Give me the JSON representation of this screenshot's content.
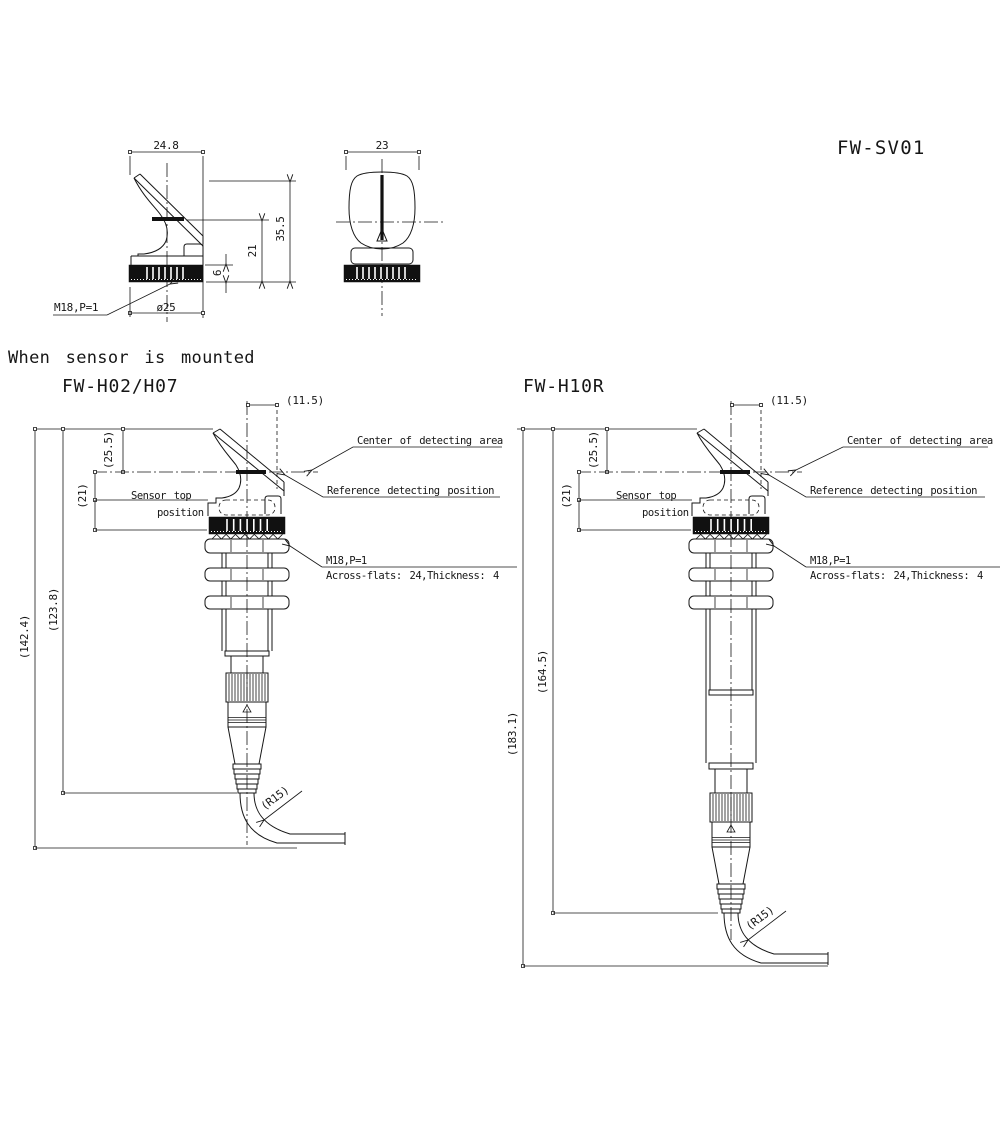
{
  "title": {
    "model": "FW-SV01"
  },
  "heading": "When sensor is mounted",
  "side_view": {
    "width": "24.8",
    "height": "35.5",
    "center_height": "21",
    "nut_height": "6",
    "diameter": "ø25",
    "thread": "M18,P=1"
  },
  "front_view": {
    "width": "23"
  },
  "left": {
    "label": "FW-H02/H07",
    "offset": "(11.5)",
    "center_depth": "(25.5)",
    "top_depth": "(21)",
    "inner_length": "(123.8)",
    "overall_length": "(142.4)",
    "bend_radius": "(R15)",
    "sensor_top_line1": "Sensor top",
    "sensor_top_line2": "position",
    "center_note": "Center of detecting area",
    "reference_note": "Reference detecting position",
    "thread": "M18,P=1",
    "flats": "Across-flats: 24,Thickness: 4"
  },
  "right": {
    "label": "FW-H10R",
    "offset": "(11.5)",
    "center_depth": "(25.5)",
    "top_depth": "(21)",
    "inner_length": "(164.5)",
    "overall_length": "(183.1)",
    "bend_radius": "(R15)",
    "sensor_top_line1": "Sensor top",
    "sensor_top_line2": "position",
    "center_note": "Center of detecting area",
    "reference_note": "Reference detecting position",
    "thread": "M18,P=1",
    "flats": "Across-flats: 24,Thickness: 4"
  }
}
